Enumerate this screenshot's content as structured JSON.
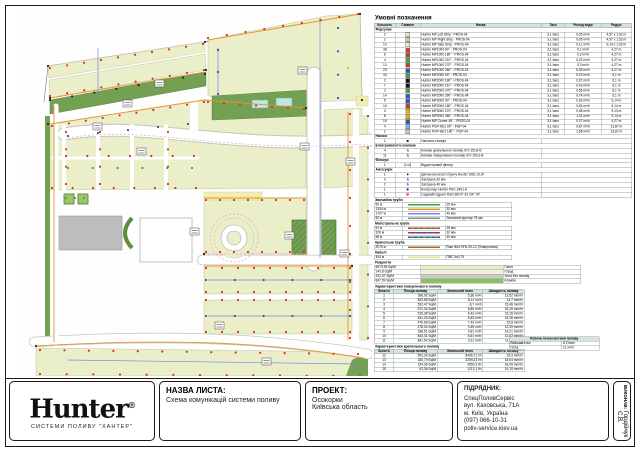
{
  "map": {
    "colors": {
      "lawn": "#eaeec9",
      "flowerbed": "#74a053",
      "hedge": "#5d8f3f",
      "no_irrigation": "#bdbdbd",
      "pond": "#bfe8e4",
      "path": "#ffffff",
      "pipe_main": "#e2952f",
      "pipe_lateral": "#7b86e0",
      "drip": "#ef9ed2",
      "sprinkler_red": "#d93025",
      "sprinkler_blue": "#2b50c8",
      "sprinkler_green": "#3fa535",
      "sprinkler_black": "#222222",
      "sprinkler_yellow": "#e8b400",
      "table_header_bg": "#d6e4e0"
    }
  },
  "legend": {
    "title": "Умовні позначення",
    "columns": [
      "Кількість",
      "Символ",
      "Назва",
      "Тиск",
      "Розхід води",
      "Радіус"
    ],
    "sections": [
      {
        "label": "Форсунки",
        "rows": [
          {
            "qty": "2",
            "sym": "square",
            "color": "#ede7c6",
            "name": "Hunter MP Left Strip - PROS-04",
            "press": "3,1 bars",
            "flow": "0,05 m³/h",
            "radius": "4,57 x 1,52 m"
          },
          {
            "qty": "2",
            "sym": "square",
            "color": "#d9c89a",
            "name": "Hunter MP Right Strip - PROS-04",
            "press": "3,1 bars",
            "flow": "0,05 m³/h",
            "radius": "4,57 x 1,52 m"
          },
          {
            "qty": "10",
            "sym": "square",
            "color": "#f2edc4",
            "name": "Hunter MP Side Strip - PROS-04",
            "press": "3,1 bars",
            "flow": "0,11 m³/h",
            "radius": "9,14 x 1,52 m"
          },
          {
            "qty": "38",
            "sym": "square",
            "color": "#d93025",
            "name": "Hunter MP1000 90° - PROS-04",
            "press": "3,1 bars",
            "flow": "0,1 m³/h",
            "radius": "4,27 m"
          },
          {
            "qty": "6",
            "sym": "square",
            "color": "#d93025",
            "name": "Hunter MP1000 180° - PROS-04",
            "press": "3,1 bars",
            "flow": "0,2 m³/h",
            "radius": "4,27 m"
          },
          {
            "qty": "4",
            "sym": "square",
            "color": "#3fa535",
            "name": "Hunter MP1000 210° - PROS-04",
            "press": "3,1 bars",
            "flow": "0,23 m³/h",
            "radius": "4,27 m"
          },
          {
            "qty": "13",
            "sym": "square",
            "color": "#d93025",
            "name": "Hunter MP1000 270° - PROS-04",
            "press": "3,1 bars",
            "flow": "0,3 m³/h",
            "radius": "4,27 m"
          },
          {
            "qty": "23",
            "sym": "square",
            "color": "#2b50c8",
            "name": "Hunter MP1000 360° - PROS-04",
            "press": "3,1 bars",
            "flow": "0,39 m³/h",
            "radius": "4,27 m"
          },
          {
            "qty": "44",
            "sym": "square",
            "color": "#3fa535",
            "name": "Hunter MP2000 90° - PROS-04",
            "press": "3,1 bars",
            "flow": "0,19 m³/h",
            "radius": "6,1 m"
          },
          {
            "qty": "2",
            "sym": "square",
            "color": "#111111",
            "name": "Hunter MP2000 180° - PROS-04",
            "press": "3,1 bars",
            "flow": "0,37 m³/h",
            "radius": "6,1 m"
          },
          {
            "qty": "7",
            "sym": "square",
            "color": "#111111",
            "name": "Hunter MP2000 210° - PROS-04",
            "press": "3,1 bars",
            "flow": "0,43 m³/h",
            "radius": "6,1 m"
          },
          {
            "qty": "3",
            "sym": "square",
            "color": "#3fa535",
            "name": "Hunter MP2000 270° - PROS-04",
            "press": "3,1 bars",
            "flow": "0,56 m³/h",
            "radius": "6,1 m"
          },
          {
            "qty": "14",
            "sym": "square",
            "color": "#2b50c8",
            "name": "Hunter MP2000 360° - PROS-04",
            "press": "3,1 bars",
            "flow": "0,74 m³/h",
            "radius": "6,1 m"
          },
          {
            "qty": "5",
            "sym": "square",
            "color": "#2b50c8",
            "name": "Hunter MP3000 90° - PROS-04",
            "press": "3,1 bars",
            "flow": "0,33 m³/h",
            "radius": "9,14 m"
          },
          {
            "qty": "16",
            "sym": "square",
            "color": "#d93025",
            "name": "Hunter MP3000 180° - PROS-04",
            "press": "3,1 bars",
            "flow": "0,65 m³/h",
            "radius": "9,14 m"
          },
          {
            "qty": "3",
            "sym": "square",
            "color": "#e8b400",
            "name": "Hunter MP3000 270° - PROS-04",
            "press": "3,1 bars",
            "flow": "0,98 m³/h",
            "radius": "9,14 m"
          },
          {
            "qty": "8",
            "sym": "square",
            "color": "#e8b400",
            "name": "Hunter MP3000 360° - PROS-04",
            "press": "3,1 bars",
            "flow": "1,31 m³/h",
            "radius": "9,14 m"
          },
          {
            "qty": "19",
            "sym": "square",
            "color": "#2b50c8",
            "name": "Hunter MP Corner 45° - PROS-04",
            "press": "3,1 bars",
            "flow": "0,07 m³/h",
            "radius": "4,27 m"
          },
          {
            "qty": "4",
            "sym": "square",
            "color": "#6fb7e8",
            "name": "Hunter PGP-ADJ 90° - PGP-04",
            "press": "3,1 bars",
            "flow": "0,87 m³/h",
            "radius": "13,87 m"
          },
          {
            "qty": "2",
            "sym": "square",
            "color": "#d9c89a",
            "name": "Hunter PGP-ADJ 180° - PGP-04",
            "press": "3,1 bars",
            "flow": "1,58 m³/h",
            "radius": "13,87 m"
          }
        ]
      },
      {
        "label": "Насоси",
        "rows": [
          {
            "qty": "1",
            "sym": "glyph",
            "glyph": "■",
            "color": "#111111",
            "name": "Насосна станція",
            "press": "",
            "flow": "",
            "radius": ""
          }
        ]
      },
      {
        "label": "Електромагнітні клапани",
        "rows": [
          {
            "qty": "4",
            "sym": "glyph",
            "glyph": "§",
            "color": "#d93025",
            "name": "Клапан крапельного поливу ICV-151G-B",
            "press": "",
            "flow": "",
            "radius": ""
          },
          {
            "qty": "11",
            "sym": "glyph",
            "glyph": "§",
            "color": "#2b50c8",
            "name": "Клапан поверхневого поливу ICV-151G-B",
            "press": "",
            "flow": "",
            "radius": ""
          }
        ]
      },
      {
        "label": "Фільтри",
        "rows": [
          {
            "qty": "1",
            "sym": "glyph",
            "glyph": "▷◁",
            "color": "#333333",
            "name": "Відцентровий фільтр",
            "press": "",
            "flow": "",
            "radius": ""
          }
        ]
      },
      {
        "label": "Аксесуари",
        "rows": [
          {
            "qty": "1",
            "sym": "glyph",
            "glyph": "●",
            "color": "#111111",
            "name": "Датчик вологості ґрунту Hunter SOIL-CLIK",
            "press": "",
            "flow": "",
            "radius": ""
          },
          {
            "qty": "3",
            "sym": "glyph",
            "glyph": "§",
            "color": "#2b50c8",
            "name": "Заглушка 32 мм",
            "press": "",
            "flow": "",
            "radius": ""
          },
          {
            "qty": "2",
            "sym": "glyph",
            "glyph": "§",
            "color": "#2b50c8",
            "name": "Заглушка 40 мм",
            "press": "",
            "flow": "",
            "radius": ""
          },
          {
            "qty": "1",
            "sym": "glyph",
            "glyph": "■",
            "color": "#333333",
            "name": "Контролер Hunter PHC-2401-E",
            "press": "",
            "flow": "",
            "radius": ""
          },
          {
            "qty": "1",
            "sym": "glyph",
            "glyph": "⊕",
            "color": "#d93025",
            "name": "Садовий гідрант Rain Bird P-33 3/4\" ЗР",
            "press": "",
            "flow": "",
            "radius": ""
          }
        ]
      }
    ],
    "pipe_sections": [
      {
        "label": "Звичайна труба",
        "rows": [
          {
            "len": "50 м",
            "style": "solid",
            "color": "#3fa535",
            "name": "25 мм"
          },
          {
            "len": "1344 м",
            "style": "solid",
            "color": "#e2952f",
            "name": "32 мм"
          },
          {
            "len": "1707 м",
            "style": "solid",
            "color": "#7b86e0",
            "name": "40 мм"
          },
          {
            "len": "52 м",
            "style": "solid",
            "color": "#8a8a8a",
            "name": "Захисний футляр 75 мм"
          }
        ]
      },
      {
        "label": "Магістральна труба",
        "rows": [
          {
            "len": "51 м",
            "style": "dash",
            "color": "#d93025",
            "color2": "#3fa535",
            "name": "25 мм"
          },
          {
            "len": "326 м",
            "style": "dash",
            "color": "#d93025",
            "color2": "#2b50c8",
            "name": "32 мм"
          },
          {
            "len": "58 м",
            "style": "dash",
            "color": "#2b50c8",
            "color2": "#3fa535",
            "name": "40 мм"
          }
        ]
      },
      {
        "label": "Крапельна труба",
        "rows": [
          {
            "len": "2076 м",
            "style": "solid",
            "color": "#a5682a",
            "name": "Rain Bird XFD-09-12 (Поверхнева)"
          }
        ]
      },
      {
        "label": "Кабелі",
        "rows": [
          {
            "len": "404 м",
            "style": "solid",
            "color": "#e8e09a",
            "name": "ПВС 5x0,75"
          }
        ]
      }
    ],
    "coverage": {
      "label": "Покриття",
      "rows": [
        {
          "area": "5674,95 Sq/M",
          "color": "#eaeec9",
          "name": "Газон"
        },
        {
          "area": "140,8 Sq/M",
          "color": "#f2efda",
          "name": "Город"
        },
        {
          "area": "202,37 Sq/M",
          "color": "#c9c9c9",
          "name": "Зона без поливу"
        },
        {
          "area": "897,59 Sq/M",
          "color": "#8cc155",
          "name": "Клумби"
        }
      ]
    },
    "zone_tables": [
      {
        "title": "Характеристики поверхневого поливу",
        "columns": [
          "Зона №",
          "Площа поливу",
          "Загальний потік",
          "Швидкість поливу"
        ],
        "rows": [
          [
            "1",
            "398,92 Sq/M",
            "5,38 m³/h",
            "13,52 mm/hr"
          ],
          [
            "2",
            "503,98 Sq/M",
            "8,11 m³/h",
            "14,7 mm/hr"
          ],
          [
            "3",
            "533,47 Sq/M",
            "8,7 m³/h",
            "15,46 mm/hr"
          ],
          [
            "4",
            "572,34 Sq/M",
            "8,89 m³/h",
            "15,49 mm/hr"
          ],
          [
            "5",
            "515,38 Sq/M",
            "8,43 m³/h",
            "15,28 mm/hr"
          ],
          [
            "6",
            "441,25 Sq/M",
            "6,83 m³/h",
            "15,26 mm/hr"
          ],
          [
            "7",
            "476,68 Sq/M",
            "7,43 m³/h",
            "15,8 mm/hr"
          ],
          [
            "8",
            "278,34 Sq/M",
            "3,45 m³/h",
            "12,39 mm/hr"
          ],
          [
            "9",
            "338,51 Sq/M",
            "4,81 m³/h",
            "14,21 mm/hr"
          ],
          [
            "10",
            "463,31 Sq/M",
            "5,61 m³/h",
            "12,62 mm/hr"
          ],
          [
            "11",
            "841,54 Sq/M",
            "9,31 m³/h",
            "11,07 mm/hr"
          ]
        ]
      },
      {
        "title": "Характеристики крапельного поливу",
        "columns": [
          "Зона №",
          "Площа поливу",
          "Загальний потік",
          "Швидкість поливу"
        ],
        "rows": [
          [
            "12",
            "503,34 Sq/M",
            "8496,71 l/h",
            "16,9 mm/hr"
          ],
          [
            "13",
            "180,79 Sq/M",
            "3259,23 l/h",
            "18,04 mm/hr"
          ],
          [
            "14",
            "154,36 Sq/M",
            "2853,3 l/h",
            "18,49 mm/hr"
          ],
          [
            "15",
            "63,36 Sq/M",
            "1213,1 l/h",
            "19,15 mm/hr"
          ]
        ]
      }
    ],
    "working_point": {
      "title": "Робоча точка системи поливу",
      "rows": [
        [
          "Робочий тиск",
          "5,2 bars"
        ],
        [
          "Потік",
          "11 m³/h"
        ]
      ]
    }
  },
  "title_block": {
    "logo": {
      "brand": "Hunter",
      "reg": "®",
      "tagline": "СИСТЕМИ ПОЛИВУ \"ХАНТЕР\""
    },
    "sheet_name": {
      "label": "НАЗВА ЛИСТА:",
      "value": "Схема комунікацій системи поливу"
    },
    "project": {
      "label": "ПРОЕКТ:",
      "line1": "Осокорки",
      "line2": "Київська область"
    },
    "contractor": {
      "label": "ПІДРЯДНИК:",
      "line1": "СпецПоливСервіс",
      "line2": "вул. Каховська, 71А",
      "line3": "м. Київ, Україна",
      "line4": "(097) 066-10-31",
      "line5": "poliv-service.kiev.ua"
    },
    "executor": {
      "label": "ВИКОНАВ:",
      "value": "Гордійчук С.В."
    }
  }
}
